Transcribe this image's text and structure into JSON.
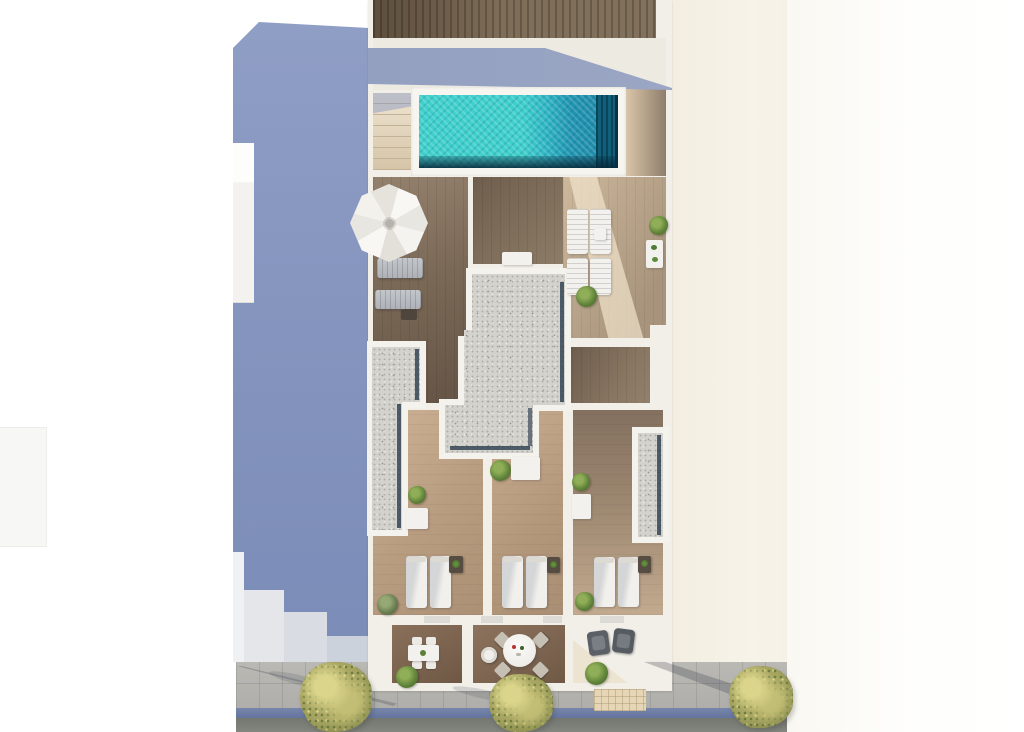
{
  "scene": {
    "title": "Aerial 3D architectural render: rooftop floor plan with swimming pool, sun decks, three bedrooms and street-side terraces",
    "type": "architectural-top-view-render",
    "labels": {
      "pergola": "dark wood pergola roof strip",
      "pool": "turquoise swimming pool with dark step grate",
      "pool_steps": "beige stair treads beside pool",
      "parasol": "white octagonal parasol",
      "skylights": "gravel skylight roofs with glass edges",
      "bedrooms": "three bedrooms with twin beds",
      "terraces": "three street-facing terraces with furniture",
      "shadow": "blue-grey building cast shadow",
      "street": "sidewalk, blue gutter strip and asphalt road with trees",
      "neighbor": "cream facade of adjacent building"
    },
    "counts": {
      "beds": 6,
      "bedrooms": 3,
      "terraces": 3,
      "white_sun_loungers": 4,
      "grey_loungers": 2,
      "street_trees": 3,
      "potted_plants": 10
    }
  },
  "colors": {
    "background": "#ffffff",
    "neighbor_cream": "#f5f0e5",
    "cast_shadow_blue": "#8494bd",
    "deck_shadow_blue": "#97a3c1",
    "pool_turquoise": "#35c9c9",
    "pool_deep_blue": "#1c86a6",
    "pool_dark_edge": "#0b3c52",
    "pergola_wood": "#6f5e4a",
    "deck_wood_dark": "#7b6957",
    "room_wood_light": "#bda189",
    "terrace_wood": "#7a6450",
    "skylight_gravel": "#d3d2cd",
    "sidewalk_grey": "#b5b4af",
    "gutter_blue": "#6e7fa7",
    "road_grey": "#7e817a",
    "tree_green": "#aaa863",
    "plant_green": "#5d8038",
    "furniture_white": "#f2f1ed",
    "wall_white": "#f2efe9"
  }
}
